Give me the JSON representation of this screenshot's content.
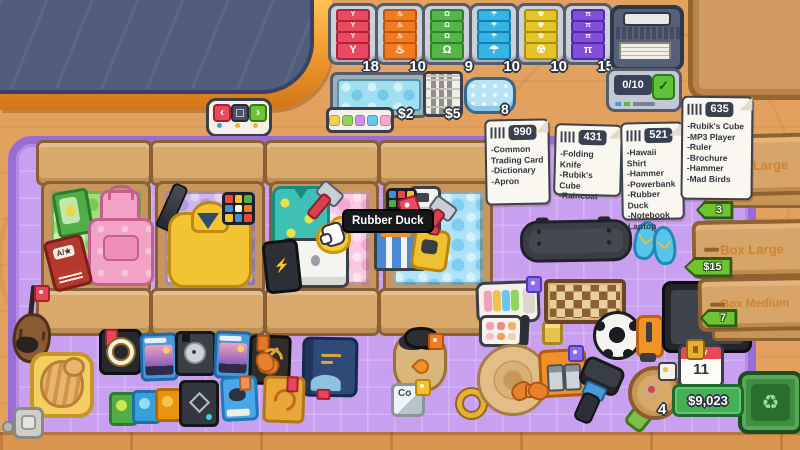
{
  "colors": {
    "desk": "#e3a15f",
    "mat": "#c9a0ef",
    "mat_border": "#9a6cd6",
    "conveyor_navy": "#515d7c",
    "conveyor_trim": "#f29b2e",
    "money_green": "#45b155",
    "calendar_red": "#e84858",
    "tooltip_black": "#17181c"
  },
  "conveyor_controls": {
    "left_glyph": "‹",
    "right_glyph": "›",
    "stop_icon": "square"
  },
  "labels": {
    "stacks": [
      {
        "name": "fragile",
        "glyph": "Y",
        "count": "18",
        "color": "#e84a5f"
      },
      {
        "name": "flammable",
        "glyph": "♨",
        "count": "10",
        "color": "#f07c22"
      },
      {
        "name": "heavy",
        "glyph": "Ω",
        "count": "9",
        "color": "#56b54a"
      },
      {
        "name": "keep-dry",
        "glyph": "☂",
        "count": "10",
        "color": "#38b4e4"
      },
      {
        "name": "hazard",
        "glyph": "☢",
        "count": "10",
        "color": "#e4c428"
      },
      {
        "name": "chemical",
        "glyph": "π",
        "count": "15",
        "color": "#8050d8"
      }
    ]
  },
  "supplies": {
    "bubble_wrap_price": "$2",
    "newspaper_price": "$5",
    "cushion_count": "8",
    "palette_colors": [
      "#f2d24c",
      "#8fd45c",
      "#cf8ef0",
      "#6cc4f0",
      "#f7a8cc"
    ]
  },
  "order_counter": {
    "value": "0/10",
    "confirm_glyph": "✓"
  },
  "orders": [
    {
      "id": "990",
      "items": [
        "-Common Trading Card",
        "-Dictionary",
        "-Apron"
      ]
    },
    {
      "id": "431",
      "items": [
        "-Folding Knife",
        "-Rubik's Cube",
        "-Raincoat"
      ]
    },
    {
      "id": "521",
      "items": [
        "-Hawaii Shirt",
        "-Hammer",
        "-Powerbank",
        "-Rubber Duck",
        "-Notebook Laptop"
      ]
    },
    {
      "id": "635",
      "items": [
        "-Rubik's Cube",
        "-MP3 Player",
        "-Ruler",
        "-Brochure",
        "-Hammer",
        "-Mad Birds"
      ]
    }
  ],
  "box_shelf": [
    {
      "label": "Box XLarge",
      "tag": "3"
    },
    {
      "label": "Box Large",
      "tag": "$15"
    },
    {
      "label": "Box Medium",
      "tag": "7"
    }
  ],
  "packing_boxes": [
    {
      "wrap": "green",
      "contents": [
        "common-trading-card",
        "dictionary",
        "apron"
      ]
    },
    {
      "wrap": "purple",
      "contents": [
        "folding-knife",
        "raincoat",
        "rubiks-cube"
      ]
    },
    {
      "wrap": "pink",
      "contents": [
        "hawaii-shirt",
        "hammer",
        "rubber-duck",
        "notebook-laptop",
        "powerbank"
      ]
    },
    {
      "wrap": "blue",
      "contents": [
        "rubiks-cube",
        "mp3-player",
        "hammer",
        "brochure",
        "mad-birds",
        "price-tag"
      ]
    }
  ],
  "tooltip": {
    "text": "Rubber Duck"
  },
  "status": {
    "day_label": "Day",
    "day_value": "11",
    "money": "$9,023",
    "toy_count": "4",
    "element_card": "Co"
  },
  "icons": {
    "recycle": "♻",
    "powerbank_bolt": "⚡"
  }
}
